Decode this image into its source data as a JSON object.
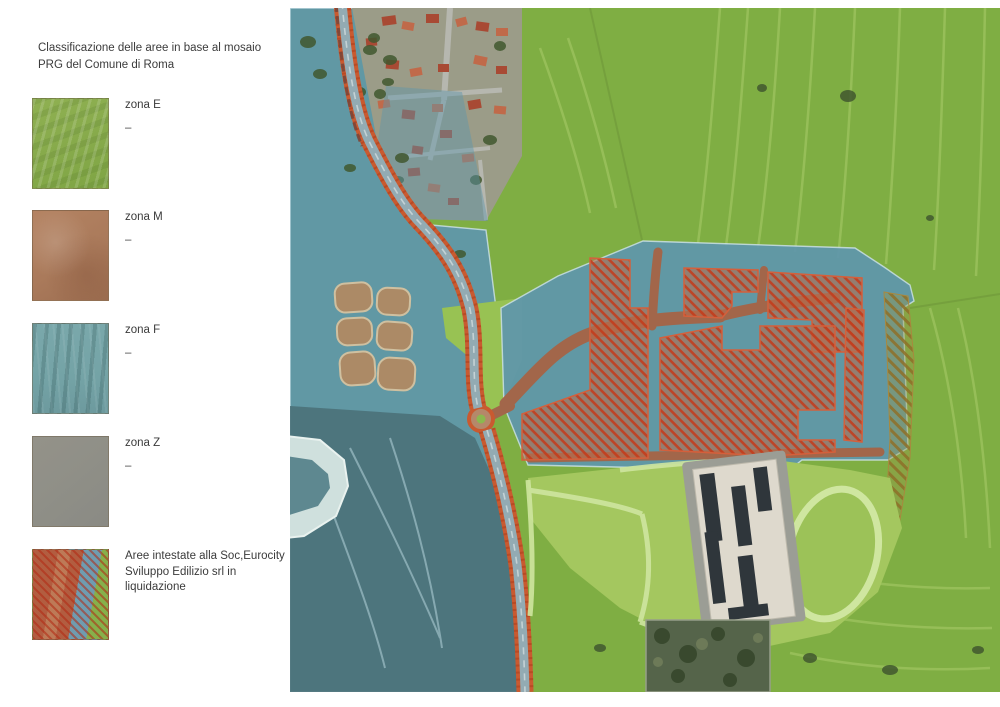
{
  "legend": {
    "title": "Classificazione delle aree in base al mosaio\nPRG del Comune di Roma",
    "items": [
      {
        "id": "zona-e",
        "label": "zona E",
        "note": "–",
        "color": "#8fb052"
      },
      {
        "id": "zona-m",
        "label": "zona M",
        "note": "–",
        "color": "#aa7a5b"
      },
      {
        "id": "zona-f",
        "label": "zona F",
        "note": "–",
        "color": "#74a3a6"
      },
      {
        "id": "zona-z",
        "label": "zona Z",
        "note": "–",
        "color": "#8f8f87"
      },
      {
        "id": "aree-eurocity",
        "label": "Aree intestate alla Soc,Eurocity Sviluppo Edilizio srl in liquidazione",
        "note": "",
        "color": "#c2441f"
      }
    ]
  },
  "map": {
    "colors": {
      "field_green": "#7fae43",
      "field_green_light": "#98c253",
      "field_streak": "#aecf6d",
      "zone_blue": "#5e96ad",
      "zone_teal_dark": "#4a6f77",
      "parcel_brown": "#a2664a",
      "hatch_red": "#c2441f",
      "road_orange": "#c95a30",
      "road_surface": "#93abb3",
      "pond_tan": "#ac8a66",
      "building_light": "#ded9cd",
      "roof_dark": "#2f363b",
      "paving_gray": "#9b9d95",
      "path_light": "#cfe6a0",
      "woods_dark": "#55644a",
      "residential_ground": "#9b9c88",
      "house_roof": "#a84a34",
      "tree_dark": "#41582f"
    }
  }
}
